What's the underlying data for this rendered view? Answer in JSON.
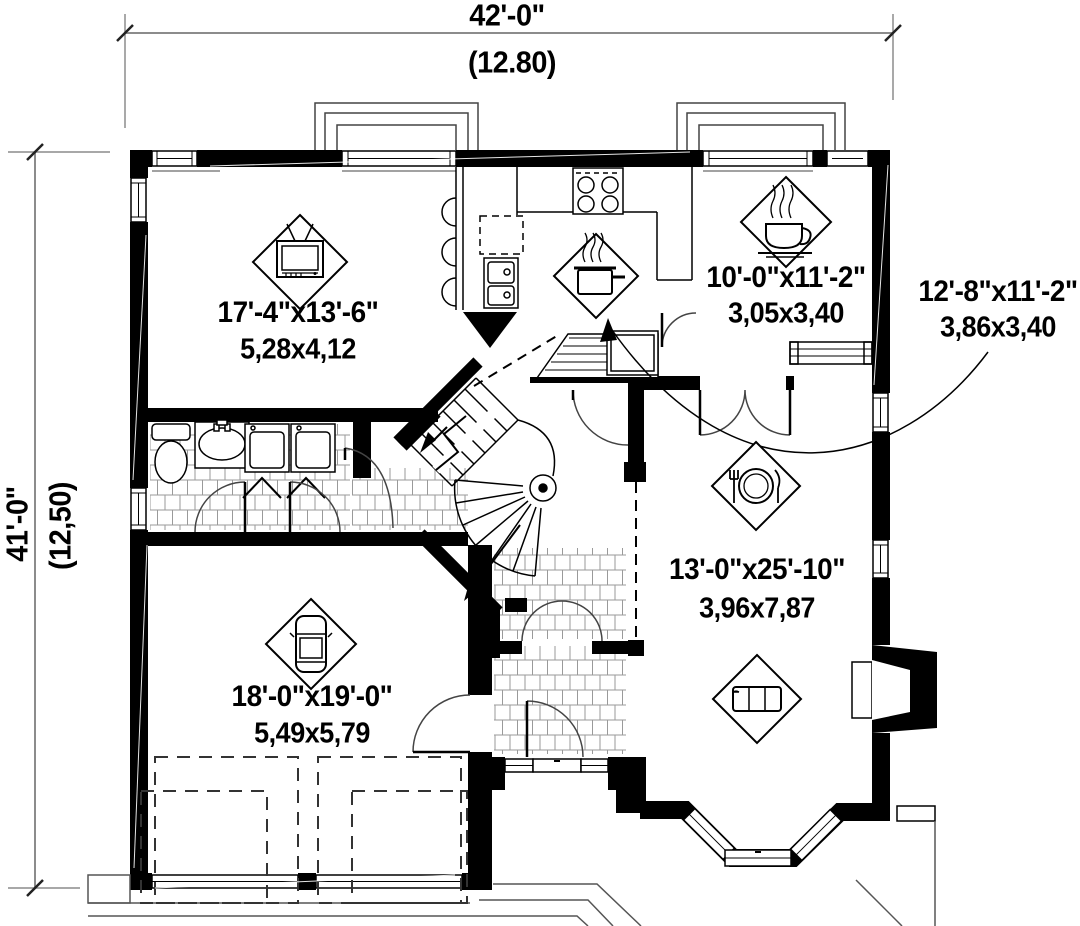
{
  "dimensions": {
    "top": {
      "imperial": "42'-0\"",
      "metric": "(12.80)"
    },
    "left": {
      "imperial": "41'-0\"",
      "metric": "(12,50)"
    }
  },
  "rooms": {
    "living": {
      "imperial": "17'-4\"x13'-6\"",
      "metric": "5,28x4,12",
      "icon": "tv-icon"
    },
    "breakfast": {
      "imperial": "10'-0\"x11'-2\"",
      "metric": "3,05x3,40",
      "icon": "coffee-cup-icon"
    },
    "kitchen": {
      "imperial": "12'-8\"x11'-2\"",
      "metric": "3,86x3,40",
      "icon": "cooking-pot-icon"
    },
    "great_room": {
      "imperial": "13'-0\"x25'-10\"",
      "metric": "3,96x7,87",
      "icon": "dining-icon"
    },
    "garage": {
      "imperial": "18'-0\"x19'-0\"",
      "metric": "5,49x5,79",
      "icon": "car-icon"
    },
    "sitting": {
      "icon": "sofa-icon"
    }
  },
  "colors": {
    "wall": "#000000",
    "line": "#000000",
    "dimension_line": "#8c8c8c",
    "tile_line": "#9a9a9a",
    "background": "#ffffff"
  }
}
